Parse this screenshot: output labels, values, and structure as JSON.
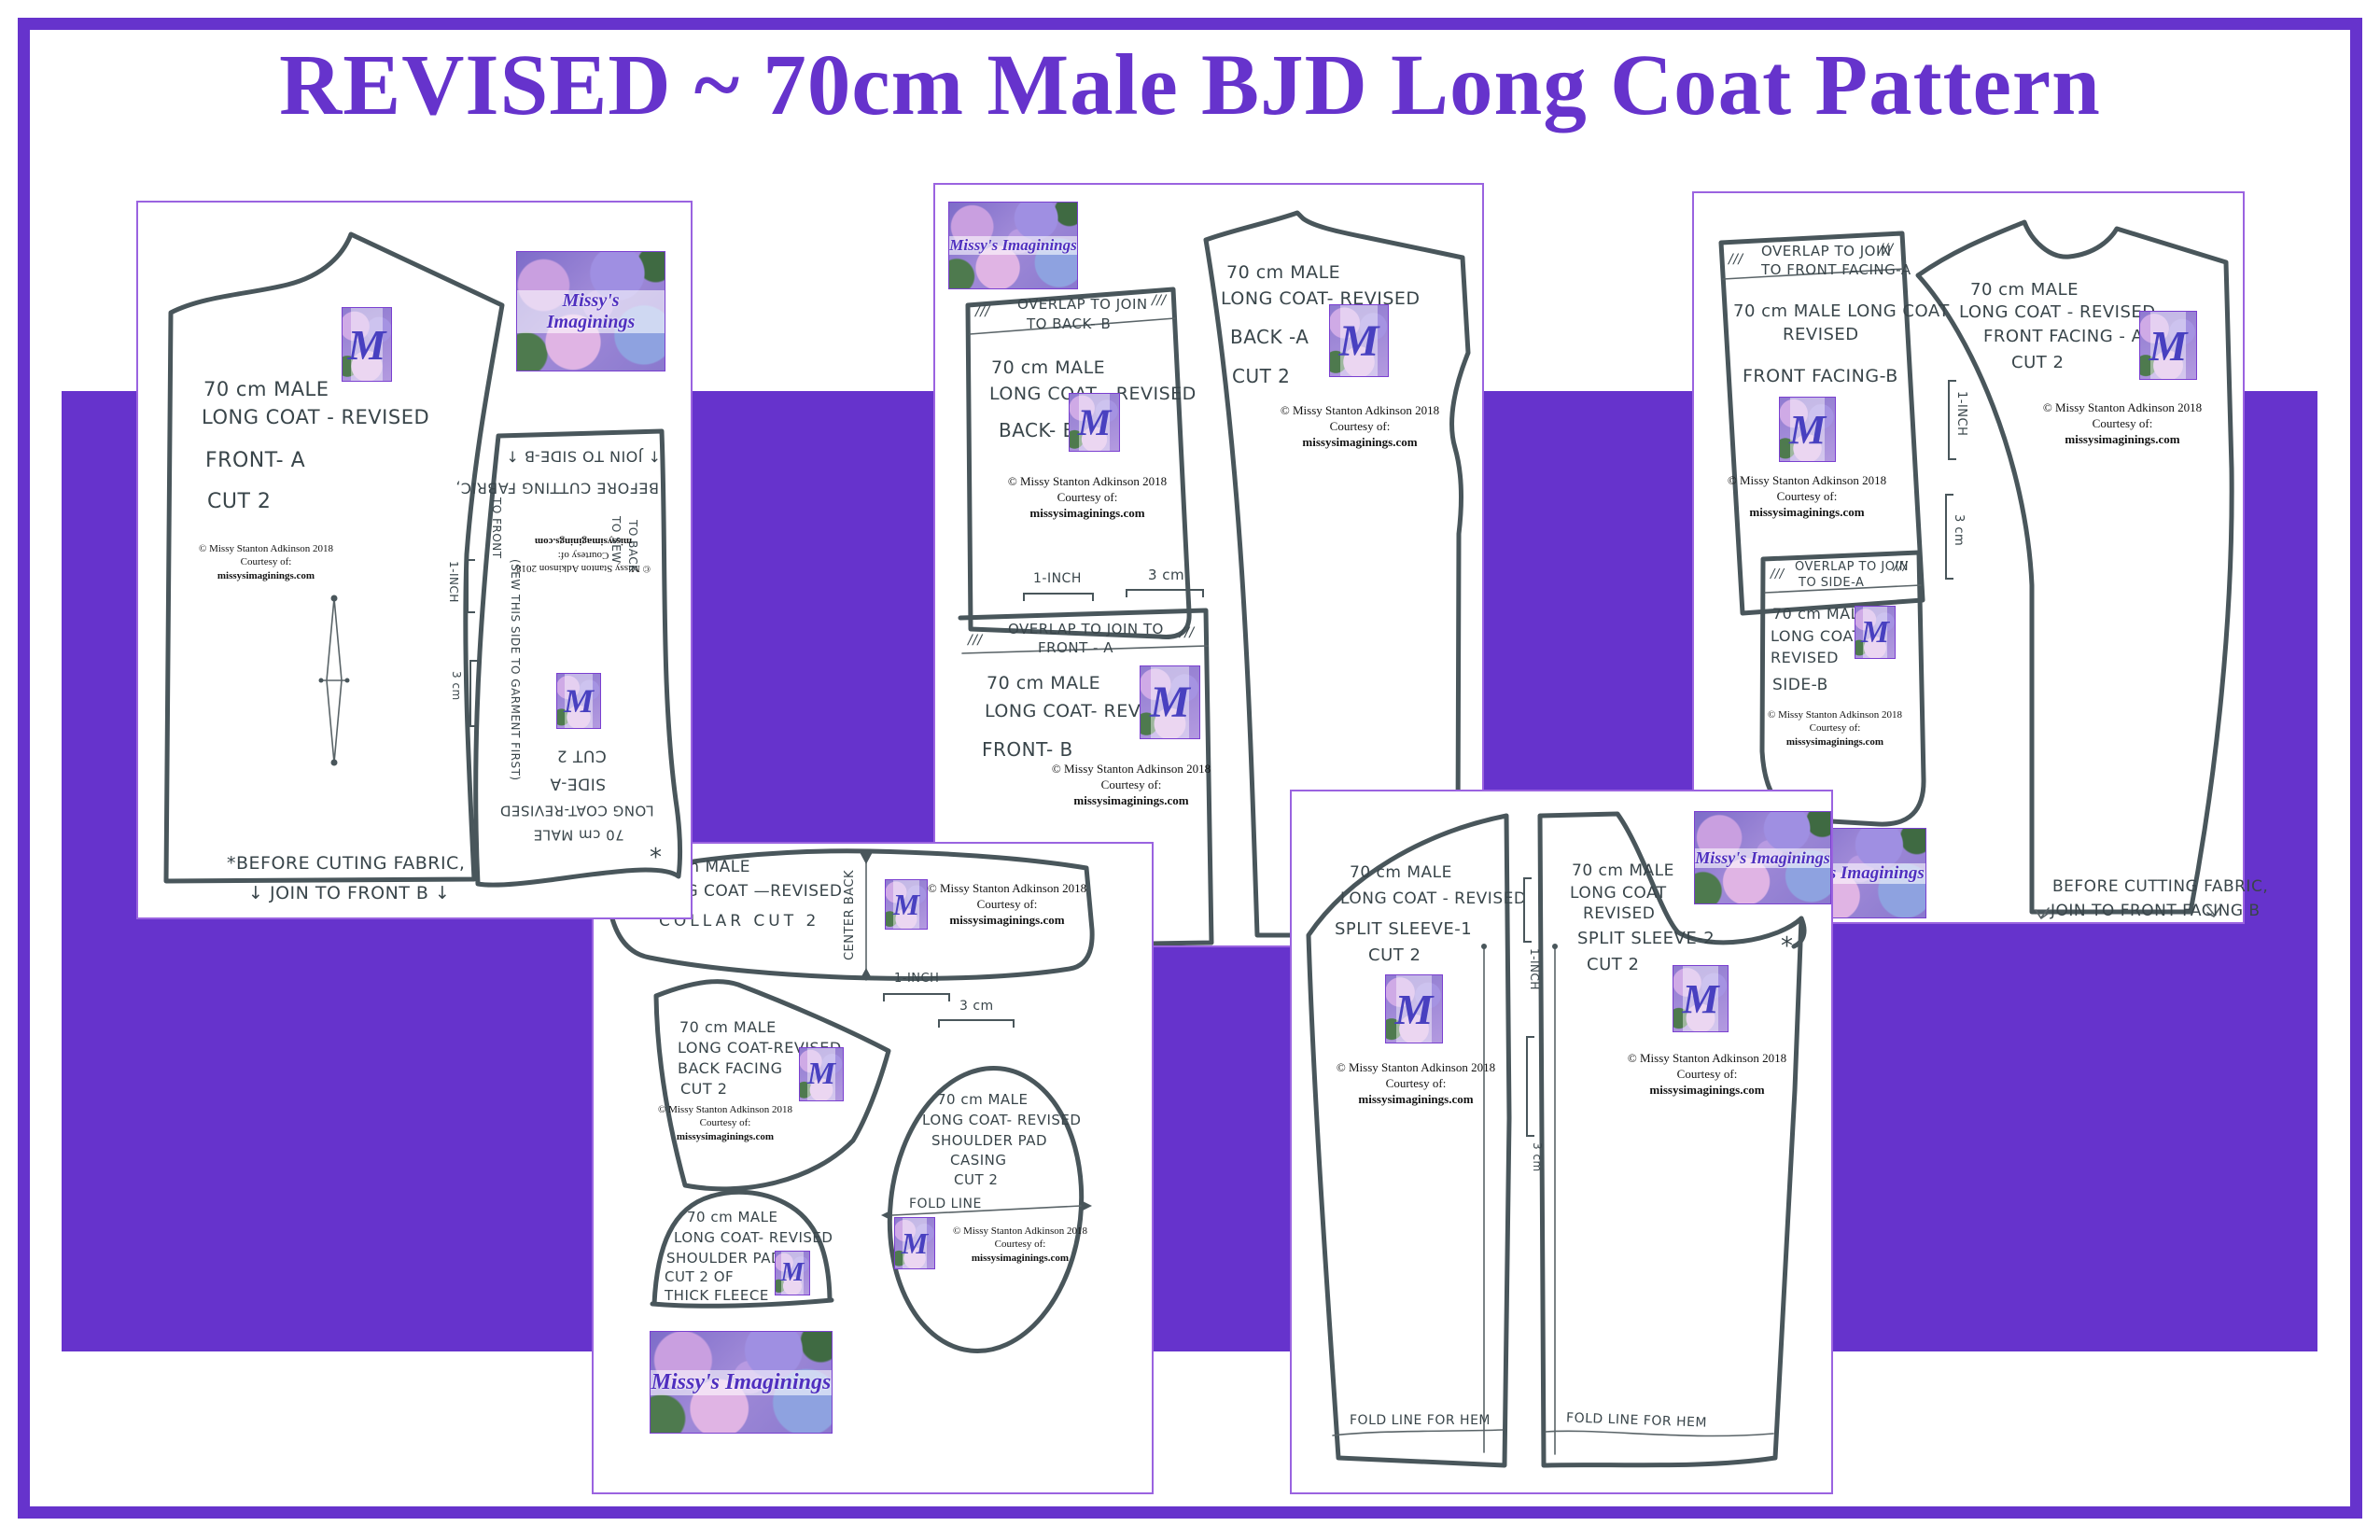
{
  "title": "REVISED ~ 70cm Male BJD Long Coat Pattern",
  "brand": {
    "banner": "Missy's Imaginings",
    "monogram": "M"
  },
  "credit": {
    "line1": "© Missy Stanton Adkinson 2018",
    "line2": "Courtesy of:",
    "line3": "missysimaginings.com"
  },
  "marks": {
    "hatch": "///",
    "asterisk": "*",
    "arrow_down": "↓",
    "arrow_up": "↑"
  },
  "rulers": {
    "inch": "1-INCH",
    "cm": "3 cm"
  },
  "sheets": {
    "one": {
      "front_a": {
        "lines": [
          "70 cm MALE",
          "LONG COAT - REVISED",
          "FRONT- A",
          "CUT 2"
        ],
        "note1": "*BEFORE CUTING FABRIC,",
        "note2": "JOIN TO FRONT B"
      },
      "side_a": {
        "flip_note1": "JOIN TO SIDE-B",
        "flip_note2": "BEFORE CUTTING FABRIC,",
        "flip_labels": [
          "CUT 2",
          "SIDE-A",
          "LONG COAT-REVISED",
          "70 cm MALE"
        ],
        "sew_note": "(SEW THIS SIDE TO GARMENT FIRST)",
        "to_front": "TO FRONT",
        "to_sew": "TO SEW",
        "to_back": "TO BACK"
      }
    },
    "two": {
      "back_b": {
        "band1": "OVERLAP TO JOIN",
        "band2": "TO BACK- B",
        "lines": [
          "70 cm MALE",
          "LONG COAT - REVISED",
          "BACK- B"
        ]
      },
      "front_b": {
        "band1": "OVERLAP TO JOIN TO",
        "band2": "FRONT - A",
        "lines": [
          "70 cm MALE",
          "LONG COAT- REVISED",
          "FRONT- B"
        ]
      },
      "back_a": {
        "lines": [
          "70 cm MALE",
          "LONG COAT- REVISED",
          "BACK -A",
          "CUT 2"
        ]
      }
    },
    "three": {
      "facing_b": {
        "band1": "OVERLAP TO JOIN",
        "band2": "TO FRONT FACING-A",
        "lines": [
          "70 cm MALE LONG COAT",
          "REVISED",
          "FRONT FACING-B"
        ]
      },
      "facing_a": {
        "lines": [
          "70 cm MALE",
          "LONG COAT - REVISED",
          "FRONT FACING - A",
          "CUT 2"
        ],
        "note1": "BEFORE CUTTING FABRIC,",
        "note2": "JOIN TO FRONT FACING B"
      },
      "side_b": {
        "band1": "OVERLAP TO JOIN",
        "band2": "TO SIDE-A",
        "lines": [
          "70 cm MALE",
          "LONG COAT",
          "REVISED",
          "SIDE-B"
        ]
      }
    },
    "four": {
      "collar": {
        "lines": [
          "70cm MALE",
          "LONG COAT —REVISED",
          "COLLAR CUT 2"
        ],
        "center_back": "CENTER BACK"
      },
      "back_facing": {
        "lines": [
          "70 cm MALE",
          "LONG COAT-REVISED",
          "BACK FACING",
          "CUT 2"
        ]
      },
      "casing": {
        "lines": [
          "70 cm MALE",
          "LONG COAT- REVISED",
          "SHOULDER PAD",
          "CASING",
          "CUT 2"
        ],
        "fold": "FOLD LINE"
      },
      "shoulder_pad": {
        "lines": [
          "70 cm MALE",
          "LONG COAT- REVISED",
          "SHOULDER PAD",
          "CUT 2 OF",
          "THICK FLEECE"
        ]
      }
    },
    "five": {
      "sleeve1": {
        "lines": [
          "70 cm MALE",
          "LONG COAT - REVISED",
          "SPLIT SLEEVE-1",
          "CUT 2"
        ],
        "fold": "FOLD LINE FOR HEM"
      },
      "sleeve2": {
        "lines": [
          "70 cm MALE",
          "LONG COAT",
          "REVISED",
          "SPLIT SLEEVE-2",
          "CUT 2"
        ],
        "fold": "FOLD LINE FOR HEM"
      }
    }
  }
}
